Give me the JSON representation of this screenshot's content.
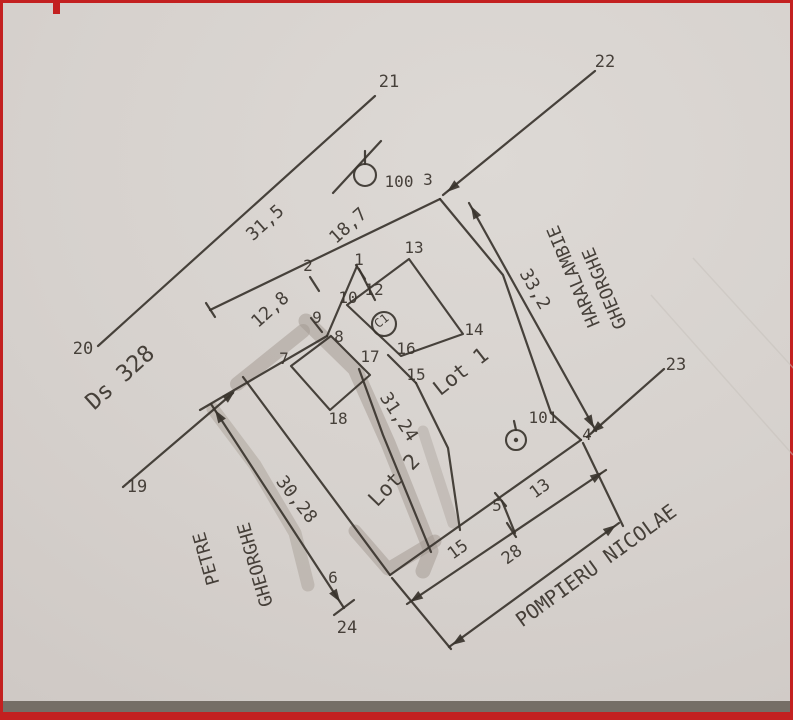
{
  "plan": {
    "colors": {
      "paper": "#d6d1cd",
      "ink": "#3a342e",
      "text": "#3a332d",
      "smudge": "#a19890",
      "crease": "#c7c1bb",
      "frame_red": "#c32020",
      "scan_band": "#756e66"
    },
    "streets": {
      "road": "Ds 328",
      "south": "POMPIERU NICOLAE",
      "east_line1": "HARALAMBIE",
      "east_line2": "GHEORGHE",
      "west_line1": "PETRE",
      "west_line2": "GHEORGHE"
    },
    "lots": {
      "lot1": "Lot 1",
      "lot2": "Lot 2",
      "building": "C1"
    },
    "stations": [
      "100",
      "101"
    ],
    "boundary_points": [
      "1",
      "2",
      "3",
      "4",
      "5",
      "6",
      "7",
      "8",
      "9",
      "10",
      "12",
      "13",
      "14",
      "15",
      "16",
      "17",
      "18",
      "19",
      "20",
      "21",
      "22",
      "23",
      "24"
    ],
    "dimensions": [
      "31,5",
      "18,7",
      "12,8",
      "33,2",
      "31,24",
      "30,28",
      "15",
      "13",
      "28"
    ],
    "labels": [
      {
        "t": "21",
        "x": 386,
        "y": 84,
        "r": 0,
        "s": 17,
        "n": "point-label-21"
      },
      {
        "t": "22",
        "x": 602,
        "y": 64,
        "r": 0,
        "s": 17,
        "n": "point-label-22"
      },
      {
        "t": "20",
        "x": 80,
        "y": 351,
        "r": 0,
        "s": 17,
        "n": "point-label-20"
      },
      {
        "t": "19",
        "x": 134,
        "y": 489,
        "r": 0,
        "s": 17,
        "n": "point-label-19"
      },
      {
        "t": "23",
        "x": 673,
        "y": 367,
        "r": 0,
        "s": 17,
        "n": "point-label-23"
      },
      {
        "t": "24",
        "x": 344,
        "y": 630,
        "r": 0,
        "s": 17,
        "n": "point-label-24"
      },
      {
        "t": "100",
        "x": 396,
        "y": 184,
        "r": 0,
        "s": 16,
        "n": "station-100-label"
      },
      {
        "t": "3",
        "x": 425,
        "y": 182,
        "r": 0,
        "s": 16,
        "n": "point-label-3"
      },
      {
        "t": "101",
        "x": 540,
        "y": 420,
        "r": 0,
        "s": 16,
        "n": "station-101-label"
      },
      {
        "t": "4",
        "x": 584,
        "y": 437,
        "r": 0,
        "s": 16,
        "n": "point-label-4"
      },
      {
        "t": "5",
        "x": 494,
        "y": 508,
        "r": 0,
        "s": 16,
        "n": "point-label-5"
      },
      {
        "t": "6",
        "x": 330,
        "y": 580,
        "r": 0,
        "s": 16,
        "n": "point-label-6"
      },
      {
        "t": "7",
        "x": 281,
        "y": 361,
        "r": 0,
        "s": 16,
        "n": "point-label-7"
      },
      {
        "t": "8",
        "x": 336,
        "y": 339,
        "r": 0,
        "s": 16,
        "n": "point-label-8"
      },
      {
        "t": "9",
        "x": 314,
        "y": 320,
        "r": 0,
        "s": 16,
        "n": "point-label-9"
      },
      {
        "t": "10",
        "x": 345,
        "y": 300,
        "r": 0,
        "s": 16,
        "n": "point-label-10"
      },
      {
        "t": "12",
        "x": 371,
        "y": 292,
        "r": 0,
        "s": 16,
        "n": "point-label-12"
      },
      {
        "t": "2",
        "x": 305,
        "y": 268,
        "r": 0,
        "s": 16,
        "n": "point-label-2"
      },
      {
        "t": "1",
        "x": 356,
        "y": 262,
        "r": 0,
        "s": 16,
        "n": "point-label-1"
      },
      {
        "t": "13",
        "x": 411,
        "y": 250,
        "r": 0,
        "s": 16,
        "n": "point-label-13"
      },
      {
        "t": "14",
        "x": 471,
        "y": 332,
        "r": 0,
        "s": 16,
        "n": "point-label-14"
      },
      {
        "t": "16",
        "x": 403,
        "y": 351,
        "r": 0,
        "s": 16,
        "n": "point-label-16"
      },
      {
        "t": "17",
        "x": 367,
        "y": 359,
        "r": 0,
        "s": 16,
        "n": "point-label-17"
      },
      {
        "t": "15",
        "x": 413,
        "y": 377,
        "r": 0,
        "s": 16,
        "n": "point-label-15"
      },
      {
        "t": "18",
        "x": 335,
        "y": 421,
        "r": 0,
        "s": 16,
        "n": "point-label-18"
      },
      {
        "t": "31,5",
        "x": 266,
        "y": 224,
        "r": -42,
        "s": 18,
        "n": "dimension-31-5"
      },
      {
        "t": "18,7",
        "x": 349,
        "y": 227,
        "r": -42,
        "s": 18,
        "n": "dimension-18-7"
      },
      {
        "t": "12,8",
        "x": 271,
        "y": 311,
        "r": -42,
        "s": 18,
        "n": "dimension-12-8"
      },
      {
        "t": "33,2",
        "x": 527,
        "y": 289,
        "r": 60,
        "s": 18,
        "n": "dimension-33-2"
      },
      {
        "t": "31,24",
        "x": 391,
        "y": 417,
        "r": 57,
        "s": 18,
        "n": "dimension-31-24"
      },
      {
        "t": "30,28",
        "x": 289,
        "y": 500,
        "r": 52,
        "s": 18,
        "n": "dimension-30-28"
      },
      {
        "t": "15",
        "x": 458,
        "y": 551,
        "r": -36,
        "s": 17,
        "n": "dimension-15"
      },
      {
        "t": "13",
        "x": 540,
        "y": 490,
        "r": -36,
        "s": 17,
        "n": "dimension-13"
      },
      {
        "t": "28",
        "x": 512,
        "y": 556,
        "r": -36,
        "s": 17,
        "n": "dimension-28"
      },
      {
        "t": "Ds 328",
        "x": 122,
        "y": 380,
        "r": -42,
        "s": 23,
        "n": "street-name-ds-328"
      },
      {
        "t": "POMPIERU NICOLAE",
        "x": 597,
        "y": 568,
        "r": -36,
        "s": 20,
        "n": "street-name-pompieru-nicolae"
      },
      {
        "t": "HARALAMBIE",
        "x": 576,
        "y": 271,
        "r": -113,
        "s": 18,
        "n": "neighbor-name-haralambie"
      },
      {
        "t": "GHEORGHE",
        "x": 607,
        "y": 283,
        "r": -113,
        "s": 18,
        "n": "neighbor-name-haralambie-gheorghe"
      },
      {
        "t": "PETRE",
        "x": 209,
        "y": 554,
        "r": -106,
        "s": 18,
        "n": "neighbor-name-petre"
      },
      {
        "t": "GHEORGHE",
        "x": 258,
        "y": 560,
        "r": -106,
        "s": 18,
        "n": "neighbor-name-petre-gheorghe"
      },
      {
        "t": "Lot 1",
        "x": 462,
        "y": 374,
        "r": -38,
        "s": 21,
        "n": "lot1-label"
      },
      {
        "t": "Lot 2",
        "x": 396,
        "y": 482,
        "r": -46,
        "s": 21,
        "n": "lot2-label"
      },
      {
        "t": "C1",
        "x": 381,
        "y": 321,
        "r": -38,
        "s": 12,
        "n": "building-c1-label"
      }
    ],
    "lines": [
      {
        "p": [
          95,
          343,
          372,
          93
        ],
        "n": "road-line-20-21"
      },
      {
        "p": [
          120,
          484,
          230,
          390
        ],
        "n": "line-19"
      },
      {
        "p": [
          592,
          68,
          440,
          192
        ],
        "n": "line-22"
      },
      {
        "p": [
          661,
          366,
          584,
          434
        ],
        "n": "line-23"
      },
      {
        "p": [
          330,
          190,
          378,
          138
        ],
        "n": "tick-near-station-100"
      },
      {
        "p": [
          207,
          307,
          437,
          196
        ],
        "n": "frontage-dimension-line"
      },
      {
        "p": [
          197,
          407,
          324,
          333
        ],
        "n": "frontage-line-west"
      },
      {
        "p": [
          324,
          333,
          354,
          263
        ],
        "n": "frontage-jog"
      },
      {
        "p": [
          356,
          266,
          372,
          297
        ],
        "n": "edge-1-12"
      },
      {
        "p": [
          387,
          572,
          578,
          437
        ],
        "n": "boundary-southeast"
      },
      {
        "p": [
          240,
          374,
          387,
          572
        ],
        "n": "boundary-southwest"
      },
      {
        "p": [
          385,
          352,
          413,
          380
        ],
        "n": "edge-16-15"
      },
      {
        "p": [
          466,
          200,
          593,
          428
        ],
        "n": "dimension-line-33-2"
      },
      {
        "p": [
          404,
          601,
          603,
          467
        ],
        "n": "dimension-line-15-13"
      },
      {
        "p": [
          446,
          644,
          616,
          520
        ],
        "n": "dimension-line-28"
      },
      {
        "p": [
          389,
          575,
          448,
          646
        ],
        "n": "extension-line-6"
      },
      {
        "p": [
          580,
          440,
          620,
          523
        ],
        "n": "extension-line-4"
      },
      {
        "p": [
          499,
          498,
          512,
          530
        ],
        "n": "extension-line-5"
      },
      {
        "p": [
          208,
          401,
          341,
          605
        ],
        "n": "dimension-line-30-28"
      },
      {
        "p": [
          203,
          300,
          212,
          314
        ],
        "n": "tick-frontage-west"
      },
      {
        "p": [
          307,
          274,
          316,
          288
        ],
        "n": "tick-point-2"
      },
      {
        "p": [
          353,
          262,
          362,
          276
        ],
        "n": "tick-point-1"
      },
      {
        "p": [
          308,
          315,
          319,
          329
        ],
        "n": "tick-point-9"
      },
      {
        "p": [
          492,
          490,
          503,
          503
        ],
        "n": "tick-point-5"
      },
      {
        "p": [
          504,
          520,
          513,
          534
        ],
        "n": "tick-dim-5"
      },
      {
        "p": [
          331,
          612,
          351,
          597
        ],
        "n": "tick-point-24"
      },
      {
        "p": [
          362,
          148,
          362,
          161
        ],
        "n": "tick-station-100"
      },
      {
        "p": [
          511,
          418,
          513,
          427
        ],
        "n": "tick-station-101"
      }
    ],
    "polylines": [
      {
        "p": [
          [
            437,
            196
          ],
          [
            500,
            272
          ],
          [
            548,
            410
          ],
          [
            578,
            437
          ]
        ],
        "n": "boundary-northeast"
      },
      {
        "p": [
          [
            356,
            366
          ],
          [
            380,
            432
          ],
          [
            428,
            549
          ]
        ],
        "n": "boundary-lot2-east"
      },
      {
        "p": [
          [
            413,
            380
          ],
          [
            445,
            445
          ],
          [
            457,
            527
          ]
        ],
        "n": "boundary-lot1-west"
      }
    ],
    "polygons": [
      {
        "p": [
          [
            288,
            363
          ],
          [
            328,
            333
          ],
          [
            367,
            372
          ],
          [
            327,
            407
          ]
        ],
        "n": "building-lot2-outline"
      },
      {
        "p": [
          [
            344,
            302
          ],
          [
            406,
            256
          ],
          [
            460,
            331
          ],
          [
            398,
            353
          ]
        ],
        "n": "building-c1-outline"
      }
    ],
    "circles": [
      {
        "cx": 362,
        "cy": 172,
        "r": 11,
        "dot": false,
        "n": "station-100-symbol"
      },
      {
        "cx": 513,
        "cy": 437,
        "r": 10,
        "dot": true,
        "n": "station-101-symbol"
      },
      {
        "cx": 381,
        "cy": 321,
        "r": 12,
        "dot": false,
        "n": "building-c1-circle"
      }
    ],
    "arrows": [
      {
        "x": 232,
        "y": 388,
        "a": -40,
        "n": "arrow-line19"
      },
      {
        "x": 444,
        "y": 189,
        "a": 141,
        "n": "arrow-line22"
      },
      {
        "x": 588,
        "y": 430,
        "a": 139,
        "n": "arrow-line23"
      },
      {
        "x": 468,
        "y": 203,
        "a": -119,
        "n": "arrow-dim-33-2-top"
      },
      {
        "x": 591,
        "y": 425,
        "a": 61,
        "n": "arrow-dim-33-2-bottom"
      },
      {
        "x": 407,
        "y": 599,
        "a": 146,
        "n": "arrow-dim-15-left"
      },
      {
        "x": 600,
        "y": 469,
        "a": -34,
        "n": "arrow-dim-13-right"
      },
      {
        "x": 449,
        "y": 642,
        "a": 146,
        "n": "arrow-dim-28-left"
      },
      {
        "x": 613,
        "y": 522,
        "a": -36,
        "n": "arrow-dim-28-right"
      },
      {
        "x": 212,
        "y": 407,
        "a": -123,
        "n": "arrow-dim-30-28-top"
      },
      {
        "x": 337,
        "y": 599,
        "a": 57,
        "n": "arrow-dim-30-28-bottom"
      }
    ],
    "smudges": [
      {
        "p": [
          [
            234,
            381
          ],
          [
            300,
            328
          ]
        ],
        "w": 14,
        "o": 0.5
      },
      {
        "p": [
          [
            303,
            318
          ],
          [
            352,
            366
          ],
          [
            385,
            440
          ],
          [
            428,
            548
          ],
          [
            420,
            568
          ]
        ],
        "w": 15,
        "o": 0.5
      },
      {
        "p": [
          [
            210,
            406
          ],
          [
            252,
            462
          ],
          [
            292,
            530
          ],
          [
            305,
            582
          ]
        ],
        "w": 13,
        "o": 0.42
      },
      {
        "p": [
          [
            420,
            428
          ],
          [
            450,
            520
          ]
        ],
        "w": 11,
        "o": 0.35
      },
      {
        "p": [
          [
            352,
            528
          ],
          [
            385,
            566
          ],
          [
            432,
            538
          ]
        ],
        "w": 13,
        "o": 0.5
      }
    ],
    "creases": [
      {
        "p": [
          648,
          292,
          790,
          452
        ]
      },
      {
        "p": [
          690,
          255,
          793,
          368
        ]
      }
    ]
  }
}
